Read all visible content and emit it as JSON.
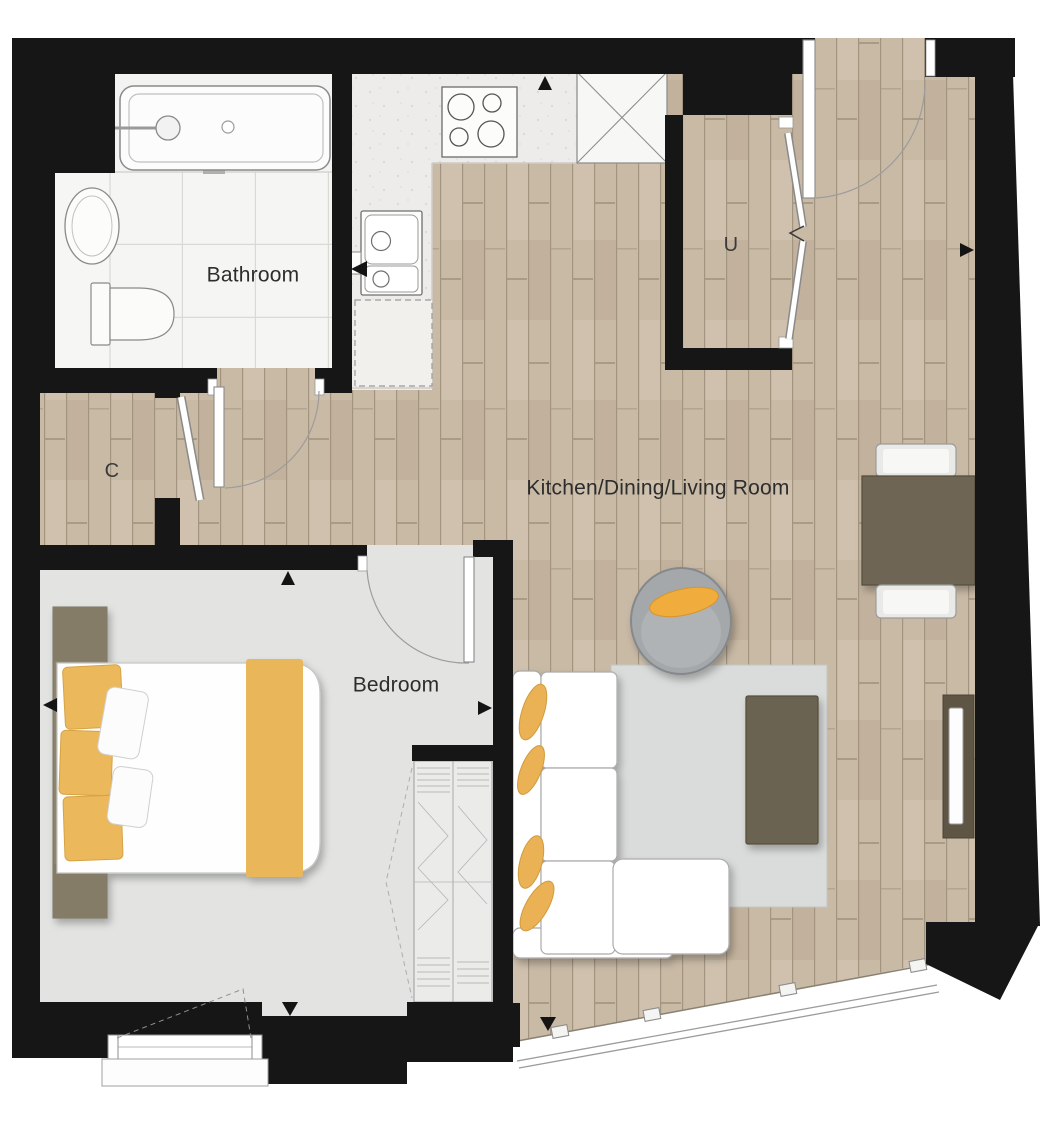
{
  "plan": {
    "type": "apartment-floor-plan",
    "rooms": [
      {
        "id": "bathroom",
        "label": "Bathroom"
      },
      {
        "id": "kitchen-dining-living",
        "label": "Kitchen/Dining/Living Room"
      },
      {
        "id": "bedroom",
        "label": "Bedroom"
      },
      {
        "id": "closet",
        "label": "C"
      },
      {
        "id": "utility",
        "label": "U"
      }
    ],
    "furniture_icons": [
      "bathtub-icon",
      "washbasin-icon",
      "toilet-icon",
      "hob-icon",
      "tall-unit-x-icon",
      "kitchen-sink-icon",
      "appliance-space-icon",
      "double-bed-icon",
      "bedside-table-icon",
      "wardrobe-icon",
      "corner-sofa-icon",
      "armchair-icon",
      "coffee-table-icon",
      "rug-icon",
      "tv-unit-icon",
      "dining-table-icon",
      "dining-chair-icon",
      "entrance-door-icon",
      "window-icon",
      "direction-marker-icon"
    ],
    "colors": {
      "wall": "#161616",
      "wood_floor": "#c9baa6",
      "wood_line": "#a3947f",
      "kitchen_floor": "#edecea",
      "tile_floor": "#f5f5f3",
      "bedroom_floor": "#e3e4e2",
      "rug": "#dadcdb",
      "accent_yellow": "#e9b75a",
      "cushion_yellow": "#f0ad3c",
      "furniture_brown": "#6e6554",
      "headboard_brown": "#8d8470",
      "armchair_gray": "#a4a8ab",
      "label_text": "#2d2d2d"
    }
  }
}
